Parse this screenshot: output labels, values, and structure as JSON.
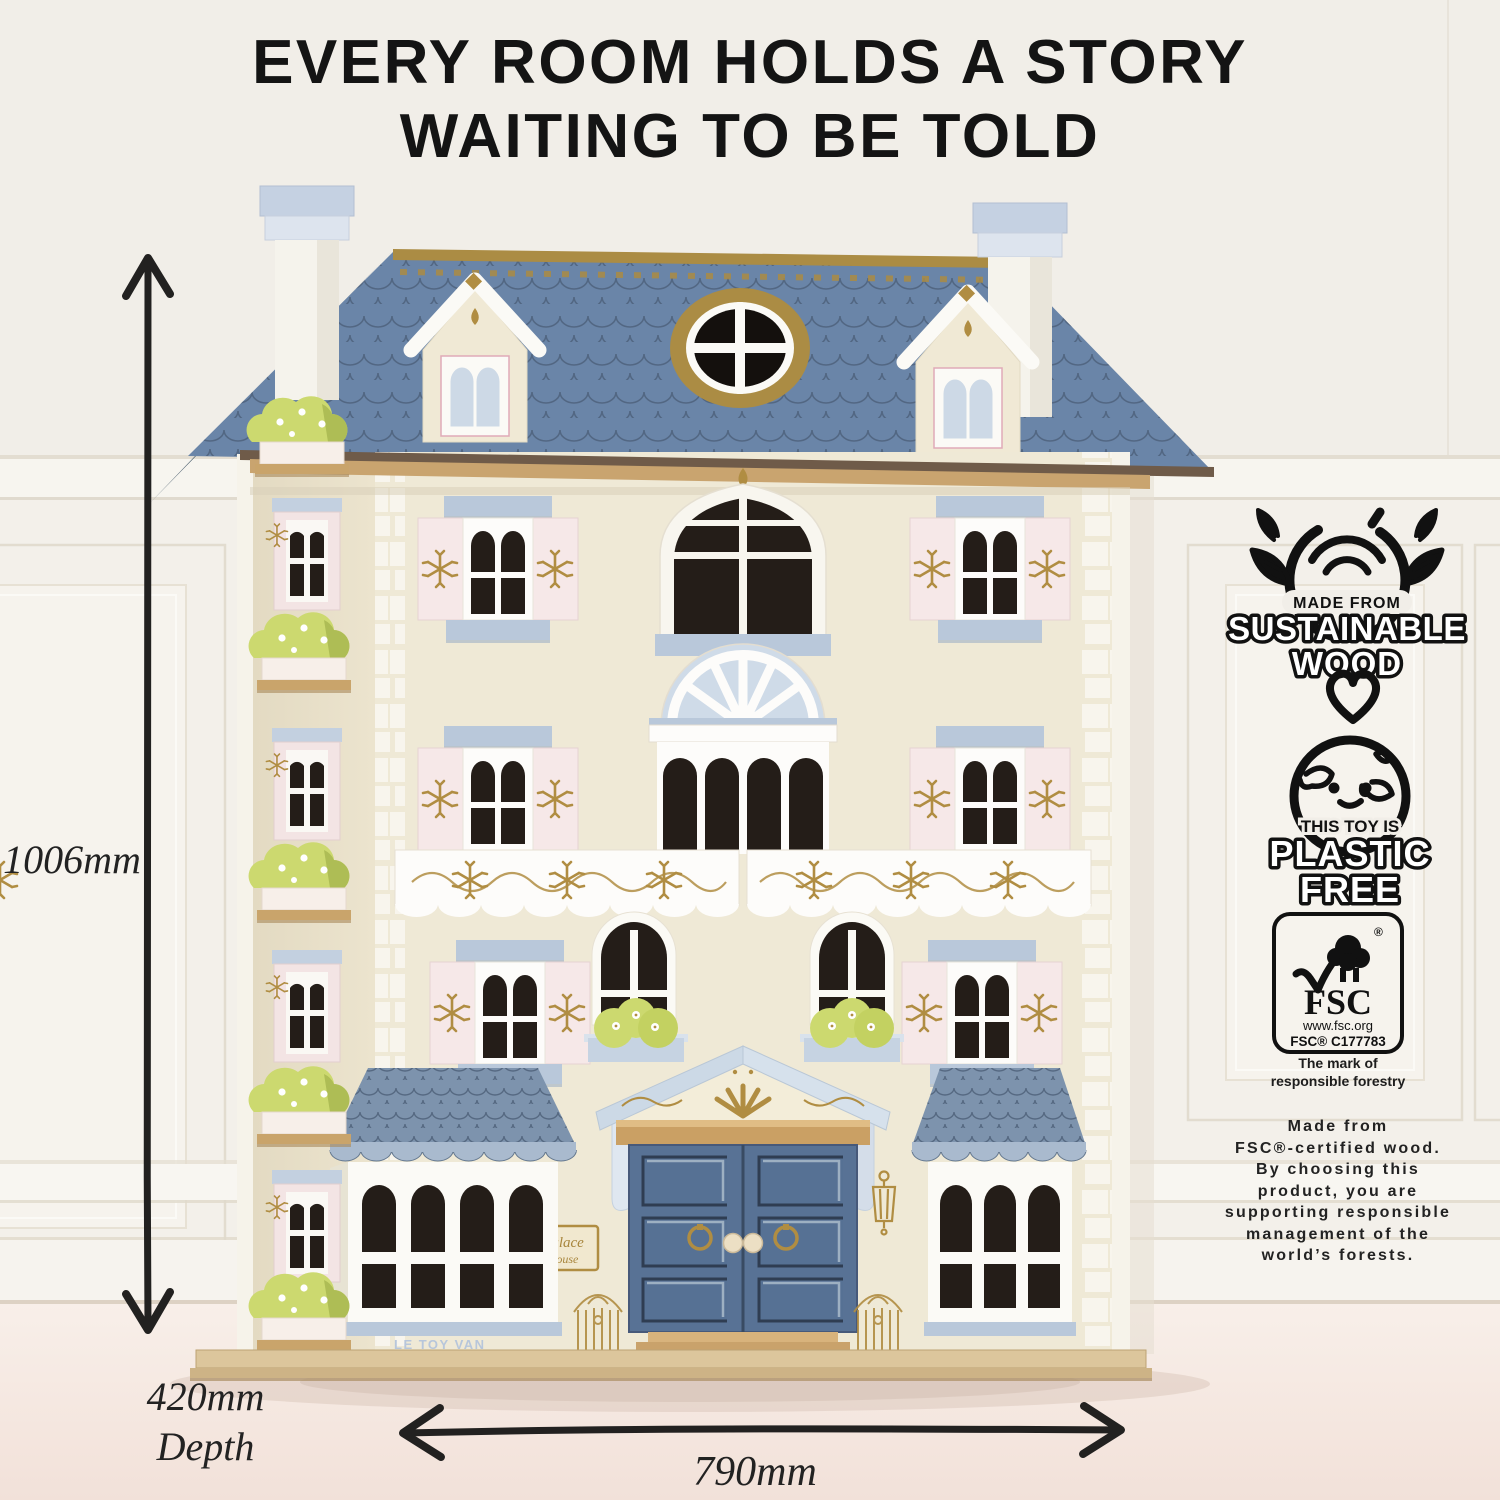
{
  "title": {
    "line1": "EVERY ROOM HOLDS A STORY",
    "line2": "WAITING TO BE TOLD"
  },
  "dimensions": {
    "height": "1006mm",
    "depth_line1": "420mm",
    "depth_line2": "Depth",
    "width": "790mm"
  },
  "house": {
    "sign_line1": "Palace",
    "sign_line2": "House",
    "brand": "LE TOY VAN"
  },
  "badges": {
    "sustainable": {
      "top": "MADE FROM",
      "line1": "SUSTAINABLE",
      "line2": "WOOD"
    },
    "plastic_free": {
      "top": "THIS TOY IS",
      "line1": "PLASTIC",
      "line2": "FREE"
    },
    "fsc": {
      "registered": "®",
      "acronym": "FSC",
      "url": "www.fsc.org",
      "license": "FSC® C177783",
      "tagline_line1": "The mark of",
      "tagline_line2": "responsible forestry"
    }
  },
  "description": {
    "lines": [
      "Made from",
      "FSC®-certified wood.",
      "By choosing this",
      "product, you are",
      "supporting responsible",
      "management of the",
      "world’s forests."
    ]
  },
  "colors": {
    "background_wall": "#f1eee8",
    "floor": "#f6ebe4",
    "roof_blue": "#6a85a8",
    "roof_line": "#42546b",
    "facade_cream": "#efe9d6",
    "side_wall_cream": "#e7dfc8",
    "shutter_pink": "#f5e6e6",
    "trim_blue": "#b9c8da",
    "door_blue": "#587295",
    "bush_green": "#ccd96f",
    "wood_tan": "#cfa871",
    "gold": "#ad8c43",
    "ink": "#1c1c1c"
  }
}
